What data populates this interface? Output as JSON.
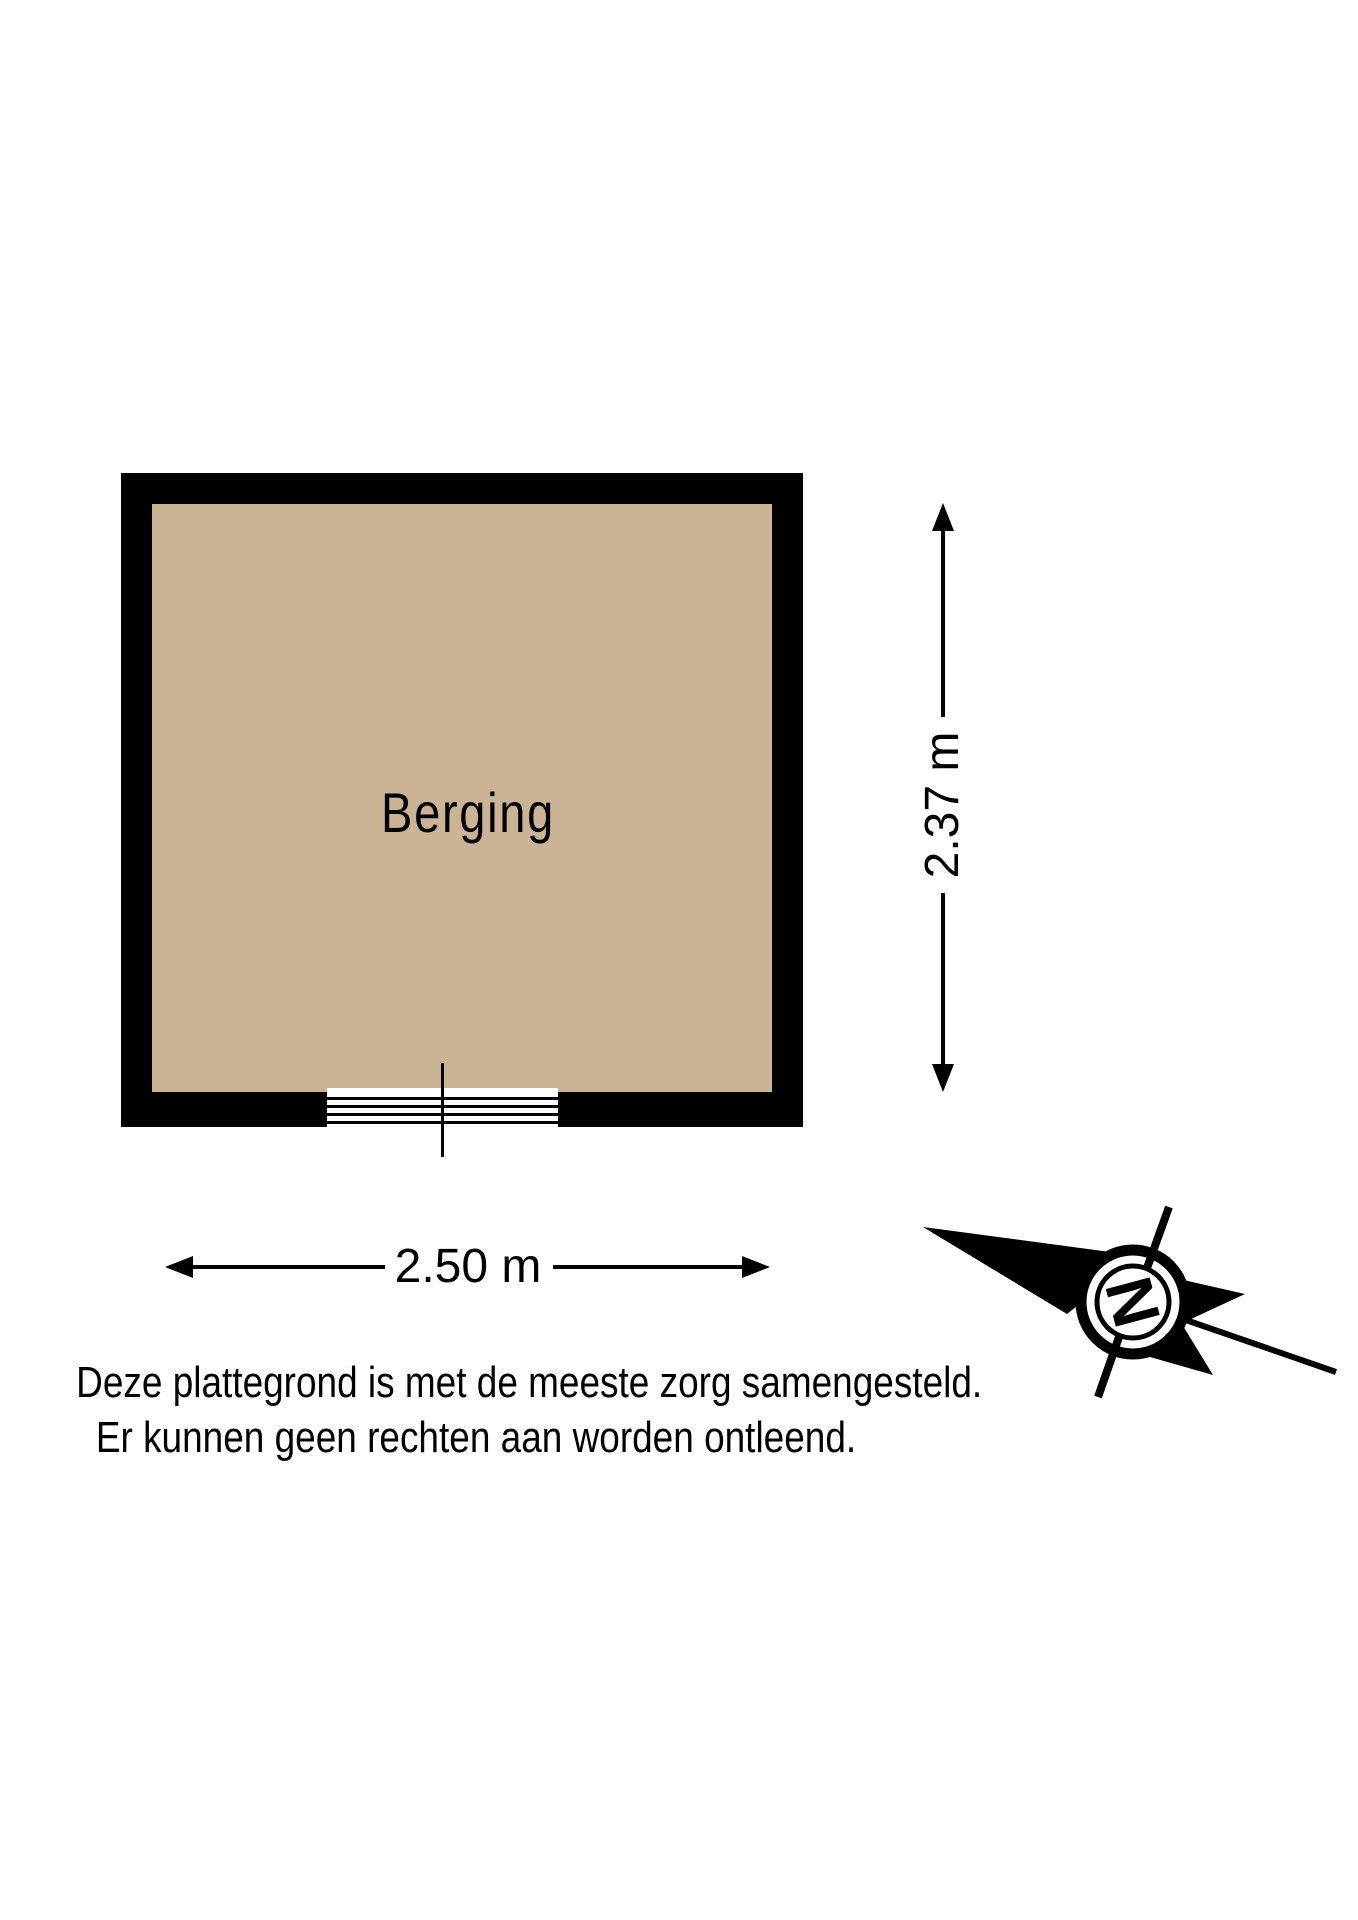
{
  "plan": {
    "room": {
      "label": "Berging"
    },
    "dimensions": {
      "width": "2.50 m",
      "height": "2.37 m"
    },
    "colors": {
      "floor": "#CBB495",
      "wall": "#000000"
    }
  },
  "disclaimer": {
    "line1": "Deze plattegrond is met de meeste zorg samengesteld.",
    "line2": "Er kunnen geen rechten aan worden ontleend."
  },
  "compass": {
    "north_letter": "N"
  }
}
